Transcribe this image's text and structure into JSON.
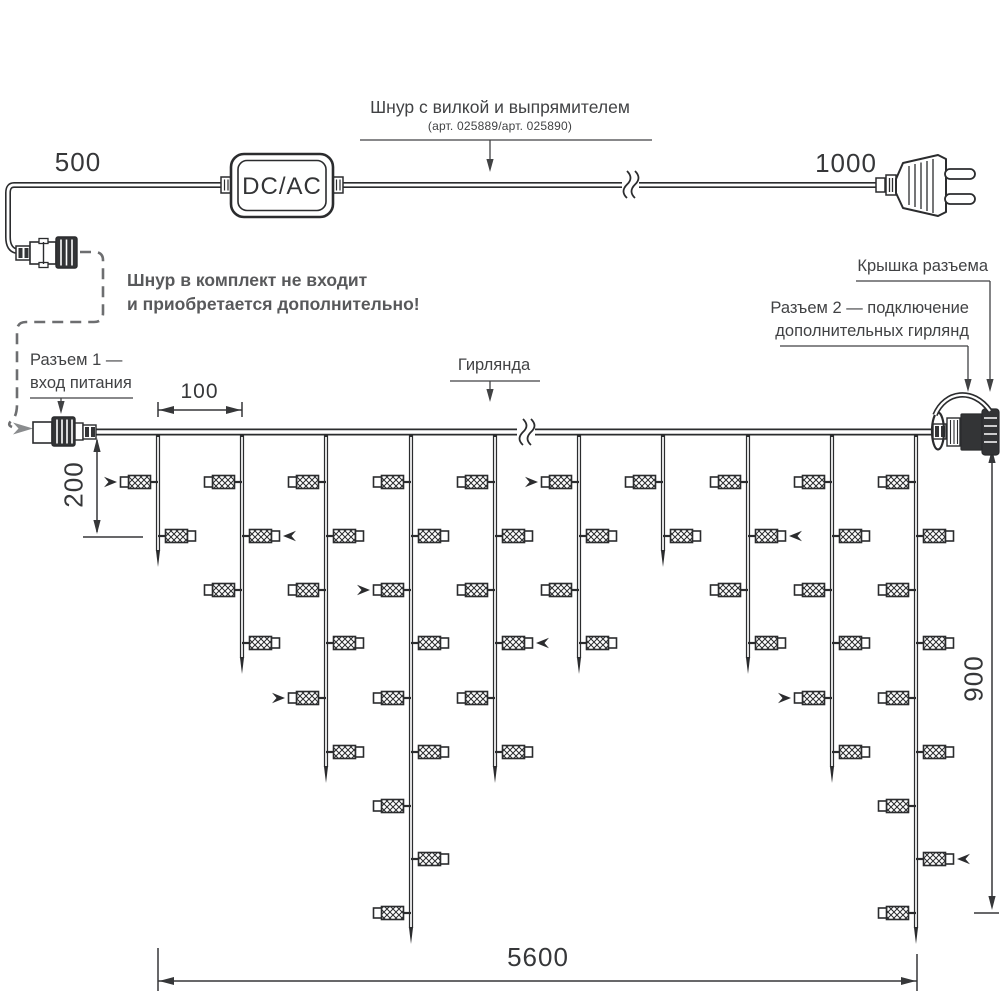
{
  "colors": {
    "line": "#2b2c2e",
    "label_text": "#414244",
    "note_text": "#58595b",
    "gray_arrow": "#8a8c8e"
  },
  "top_section": {
    "cord_length_left": "500",
    "cord_length_right": "1000",
    "converter_label": "DC/AC",
    "cord_label": "Шнур с вилкой и выпрямителем",
    "cord_sublabel": "(арт. 025889/арт. 025890)",
    "note_line1": "Шнур в комплект не входит",
    "note_line2": "и приобретается дополнительно!"
  },
  "labels": {
    "connector1_line1": "Разъем 1 —",
    "connector1_line2": "вход питания",
    "garland": "Гирлянда",
    "cap": "Крышка разъема",
    "connector2_line1": "Разъем 2 — подключение",
    "connector2_line2": "дополнительных гирлянд"
  },
  "dimensions": {
    "drop_spacing": "100",
    "first_drop_length": "200",
    "curtain_height": "900",
    "curtain_width": "5600"
  },
  "garland": {
    "wire_y": 432,
    "wire_x1": 95,
    "wire_x2": 933,
    "drop_xs": [
      158,
      242,
      326,
      411,
      495,
      579,
      663,
      748,
      832,
      916
    ],
    "lamp_rows_y": [
      482,
      536,
      590,
      643,
      698,
      752,
      806,
      859,
      913
    ],
    "tip_extension": 31,
    "drops": [
      {
        "lamps": 2,
        "arrows": [
          {
            "row": 1,
            "side": "left"
          }
        ]
      },
      {
        "lamps": 4,
        "arrows": [
          {
            "row": 2,
            "side": "right"
          }
        ]
      },
      {
        "lamps": 6,
        "arrows": [
          {
            "row": 5,
            "side": "left"
          }
        ]
      },
      {
        "lamps": 9,
        "arrows": [
          {
            "row": 3,
            "side": "left"
          }
        ]
      },
      {
        "lamps": 6,
        "arrows": [
          {
            "row": 4,
            "side": "right"
          }
        ]
      },
      {
        "lamps": 4,
        "arrows": [
          {
            "row": 1,
            "side": "left"
          }
        ]
      },
      {
        "lamps": 2,
        "arrows": []
      },
      {
        "lamps": 4,
        "arrows": [
          {
            "row": 2,
            "side": "right"
          }
        ]
      },
      {
        "lamps": 6,
        "arrows": [
          {
            "row": 5,
            "side": "left"
          }
        ]
      },
      {
        "lamps": 9,
        "arrows": [
          {
            "row": 8,
            "side": "right"
          }
        ]
      }
    ]
  }
}
